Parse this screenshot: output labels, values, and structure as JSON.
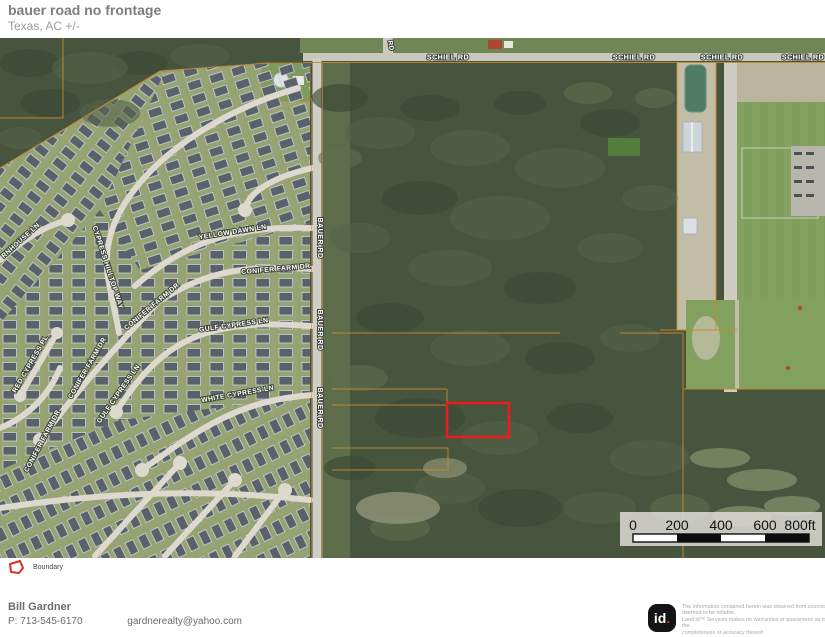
{
  "header": {
    "title": "bauer road no frontage",
    "subtitle": "Texas,  AC +/-"
  },
  "map": {
    "roads": {
      "schiel": "SCHIEL RD",
      "bauer": "BAUER RD",
      "unnamed_partial": "RD"
    },
    "streets": {
      "rnhouse": "RNHOUSE LN",
      "cypress_hilltop": "CYPRESS HILLTOP WAY",
      "yellow_dawn": "YELLOW DAWN LN",
      "conifer_farm": "CONIFER FARM DR",
      "gulf_cypress": "GULF CYPRESS LN",
      "white_cypress": "WHITE CYPRESS LN",
      "red_cypress": "RED CYPRESS PL"
    },
    "scale_bar": {
      "ticks": [
        "0",
        "200",
        "400",
        "600",
        "800ft"
      ]
    }
  },
  "legend": {
    "boundary_label": "Boundary"
  },
  "footer": {
    "agent_name": "Bill Gardner",
    "phone": "P: 713-545-6170",
    "email": "gardnerealty@yahoo.com"
  },
  "attribution": {
    "logo_text": "id",
    "logo_dot": ".",
    "disclaimer_lines": [
      "The information contained herein was obtained from sources",
      "deemed to be reliable.",
      " Land id™ Services makes no warranties or guarantees as to the",
      "completeness or accuracy thereof."
    ]
  },
  "colors": {
    "boundary": "#ea1d1b",
    "parcel_line": "#c98a2e",
    "logo_accent": "#e8251f"
  }
}
